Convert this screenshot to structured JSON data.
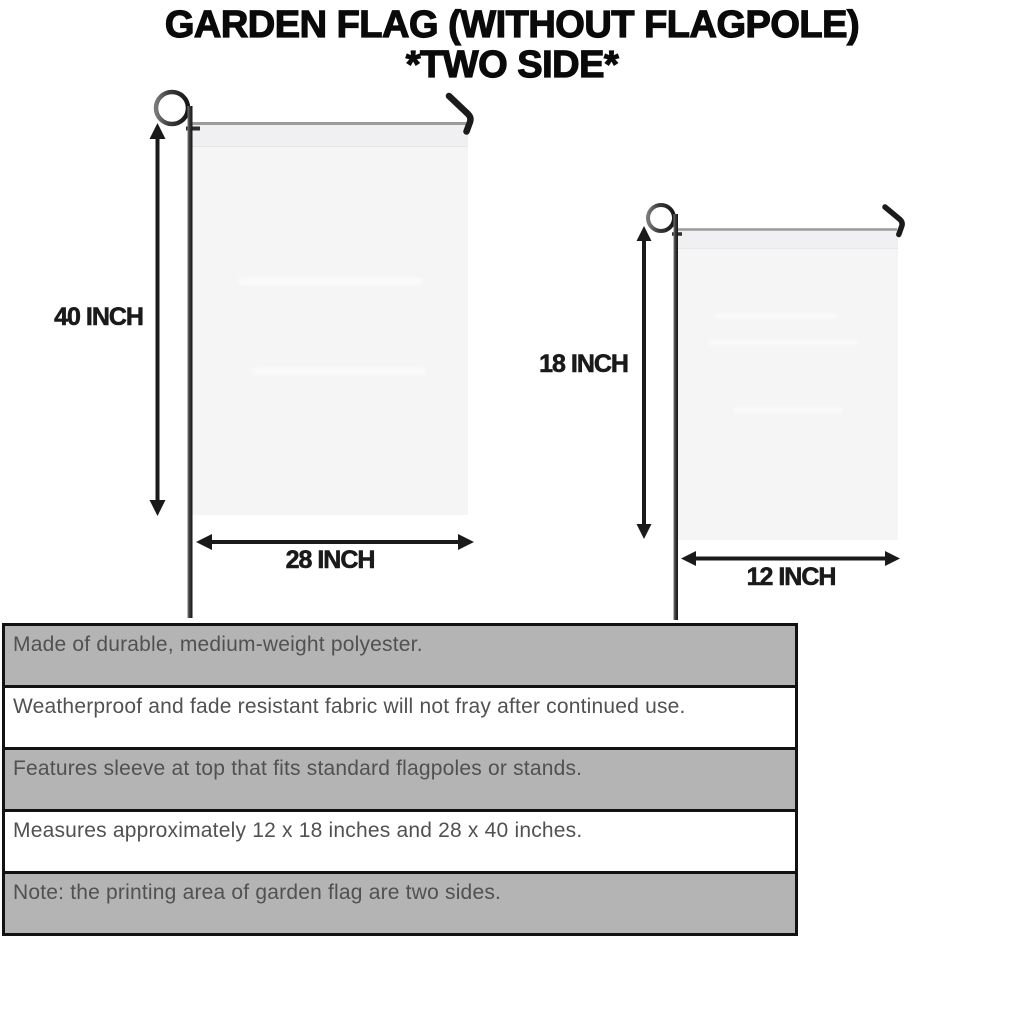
{
  "title": {
    "line1": "GARDEN FLAG (WITHOUT FLAGPOLE)",
    "line2": "*TWO SIDE*"
  },
  "large_flag": {
    "height_label": "40 INCH",
    "width_label": "28 INCH"
  },
  "small_flag": {
    "height_label": "18 INCH",
    "width_label": "12 INCH"
  },
  "spec_table": {
    "rows": [
      "Made of durable, medium-weight polyester.",
      "Weatherproof and fade resistant fabric will not fray after continued use.",
      "Features sleeve at top that fits standard flagpoles or stands.",
      "Measures approximately 12 x 18 inches and 28 x 40 inches.",
      "Note: the printing area of garden flag are two sides."
    ]
  },
  "icons": {
    "pole_loop": "flagpole-loop-icon",
    "pole_hook": "flagpole-hook-icon",
    "arrow": "double-arrow-icon"
  },
  "colors": {
    "title_black": "#0a0a0a",
    "arrow_black": "#1a1a1a",
    "table_border": "#121212",
    "table_text": "#515151",
    "row_gray": "#b4b4b4",
    "row_white": "#ffffff",
    "flag_fill": "#f5f5f6",
    "flag_sleeve": "#f0f0f2",
    "crossbar_gray": "#9c9c9c",
    "pole_dark": "#2e2e2e"
  }
}
